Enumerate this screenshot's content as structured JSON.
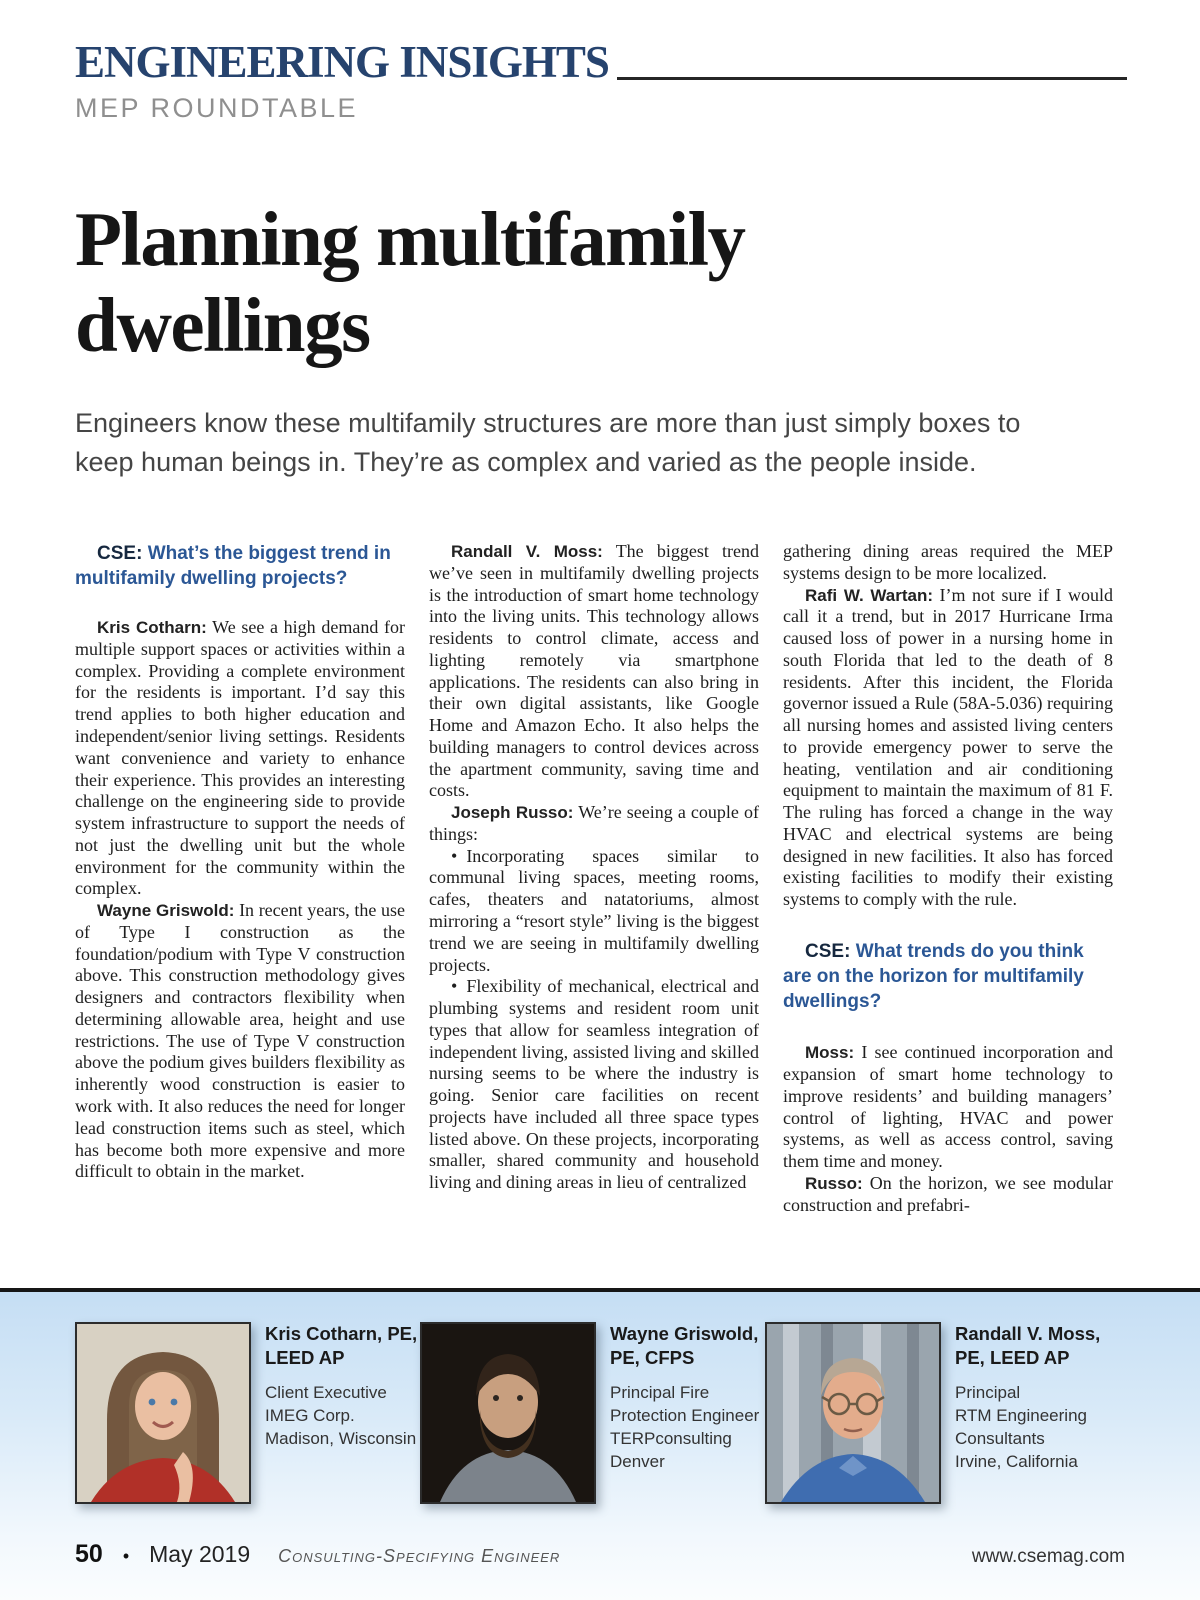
{
  "header": {
    "section_title": "ENGINEERING INSIGHTS",
    "section_subtitle": "MEP ROUNDTABLE"
  },
  "article": {
    "title": "Planning multifamily dwellings",
    "deck": "Engineers know these multifamily structures are more than just simply boxes to keep human beings in. They’re as complex and varied as the people inside."
  },
  "glyphs": {
    "bullet": "•"
  },
  "columns": {
    "col1": {
      "question": {
        "label": "CSE:",
        "text": "What’s the biggest trend in multifamily dwelling projects?"
      },
      "para1": {
        "speaker": "Kris Cotharn:",
        "text": "We see a high demand for multiple support spaces or activities within a complex. Providing a complete environment for the residents is important. I’d say this trend applies to both higher education and independent/senior living settings. Residents want convenience and variety to enhance their experience. This provides an interesting challenge on the engineering side to provide system infrastructure to support the needs of not just the dwelling unit but the whole environment for the community within the complex."
      },
      "para2": {
        "speaker": "Wayne Griswold:",
        "text": "In recent years, the use of Type I construction as the foundation/podium with Type V construction above. This construction methodology gives designers and contractors flexibility when determining allowable area, height and use restrictions. The use of Type V construction above the podium gives builders flexibility as inherently wood construction is easier to work with. It also reduces the need for longer lead construction items such as steel, which has become both more expensive and more difficult to obtain in the market."
      }
    },
    "col2": {
      "para1": {
        "speaker": "Randall V. Moss:",
        "text": "The biggest trend we’ve seen in multifamily dwelling projects is the introduction of smart home technology into the living units. This technology allows residents to control climate, access and lighting remotely via smartphone applications. The residents can also bring in their own digital assistants, like Google Home and Amazon Echo. It also helps the building managers to control devices across the apartment community, saving time and costs."
      },
      "para2": {
        "speaker": "Joseph Russo:",
        "text": "We’re seeing a couple of things:"
      },
      "bullet1": "Incorporating spaces similar to communal living spaces, meeting rooms, cafes, theaters and natatoriums, almost mirroring a “resort style” living is the biggest trend we are seeing in multifamily dwelling projects.",
      "bullet2": "Flexibility of mechanical, electrical and plumbing systems and resident room unit types that allow for seamless integration of independent living, assisted living and skilled nursing seems to be where the industry is going. Senior care facilities on recent projects have included all three space types listed above. On these projects, incorporating smaller, shared community and household living and dining areas in lieu of centralized"
    },
    "col3": {
      "para0": "gathering dining areas required the MEP systems design to be more localized.",
      "para1": {
        "speaker": "Rafi W. Wartan:",
        "text": "I’m not sure if I would call it a trend, but in 2017 Hurricane Irma caused loss of power in a nursing home in south Florida that led to the death of 8 residents. After this incident, the Florida governor issued a Rule (58A-5.036) requiring all nursing homes and assisted living centers to provide emergency power to serve the heating, ventilation and air conditioning equipment to maintain the maximum of 81 F. The ruling has forced a change in the way HVAC and electrical systems are being designed in new facilities. It also has forced existing facilities to modify their existing systems to comply with the rule."
      },
      "question": {
        "label": "CSE:",
        "text": "What trends do you think are on the horizon for multifamily dwellings?"
      },
      "para2": {
        "speaker": "Moss:",
        "text": "I see continued incorporation and expansion of smart home technology to improve residents’ and building managers’ control of lighting, HVAC and power systems, as well as access control, saving them time and money."
      },
      "para3": {
        "speaker": "Russo:",
        "text": "On the horizon, we see modular construction and prefabri-"
      }
    }
  },
  "bios": [
    {
      "name": "Kris Cotharn, PE, LEED AP",
      "lines": [
        "Client Executive",
        "IMEG Corp.",
        "Madison, Wisconsin"
      ]
    },
    {
      "name": "Wayne Griswold, PE, CFPS",
      "lines": [
        "Principal Fire Protection Engineer",
        "TERPconsulting",
        "Denver"
      ]
    },
    {
      "name": "Randall V. Moss, PE, LEED AP",
      "lines": [
        "Principal",
        "RTM Engineering Consultants",
        "Irvine, California"
      ]
    }
  ],
  "footer": {
    "page_number": "50",
    "separator": "•",
    "issue_date": "May 2019",
    "magazine_name": "Consulting-Specifying Engineer",
    "website": "www.csemag.com"
  },
  "colors": {
    "navy_heading": "#26436e",
    "question_blue": "#2b5795",
    "question_label_navy": "#16283f",
    "panel_blue_top": "#c5def4",
    "panel_blue_bottom": "#fbfdfe",
    "rule_dark": "#262626"
  }
}
